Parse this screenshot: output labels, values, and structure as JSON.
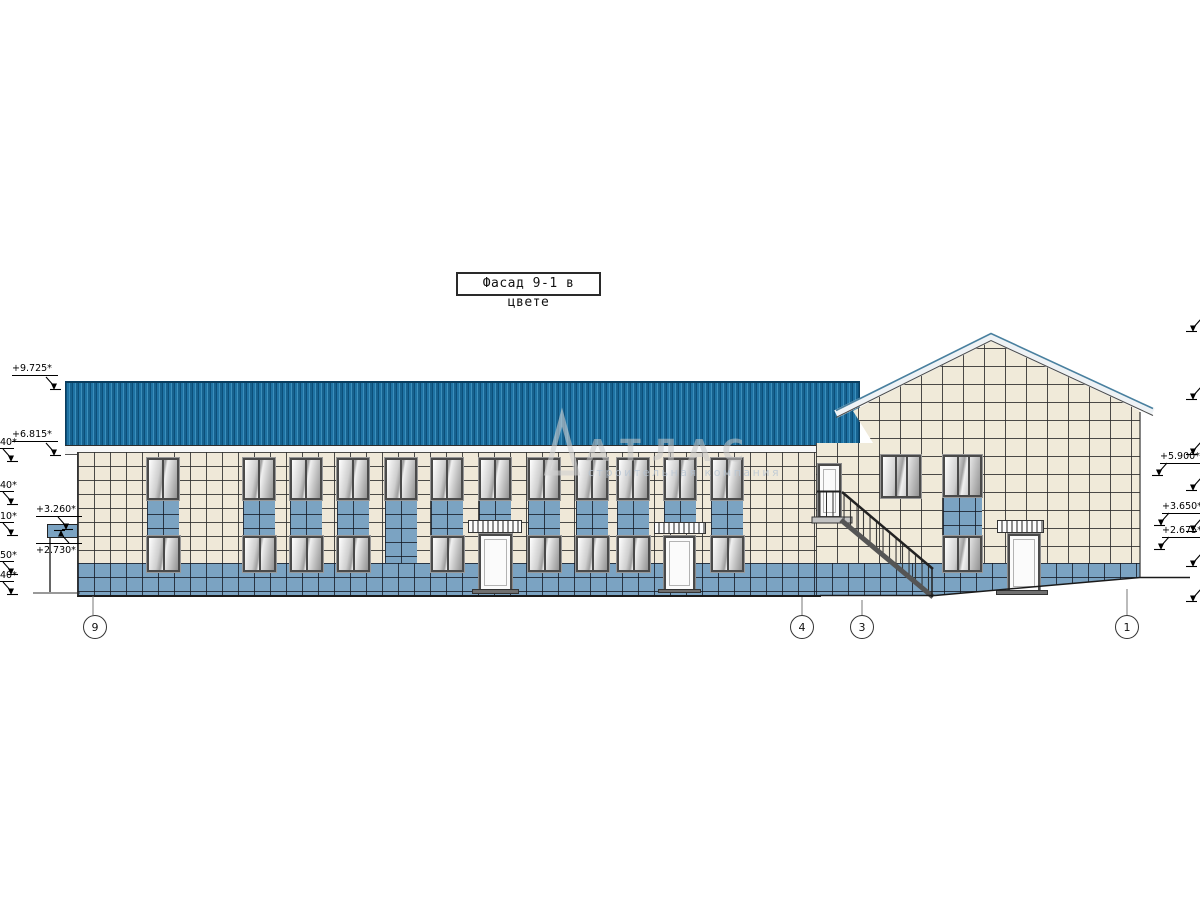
{
  "drawing": {
    "title": "Фасад 9-1 в цвете"
  },
  "watermark": {
    "name": "АТЛАС",
    "subtitle": "строительная компания"
  },
  "elevation_markers": {
    "left": [
      "+9.725*",
      "+6.815*",
      "+3.260*",
      "+2.730*"
    ],
    "left_clipped": [
      "40*",
      "40*",
      "10*",
      "50*",
      "40*"
    ],
    "right": [
      "+5.900*",
      "+3.650*",
      "+2.675*"
    ]
  },
  "axis_bubbles": [
    "9",
    "4",
    "3",
    "1"
  ]
}
